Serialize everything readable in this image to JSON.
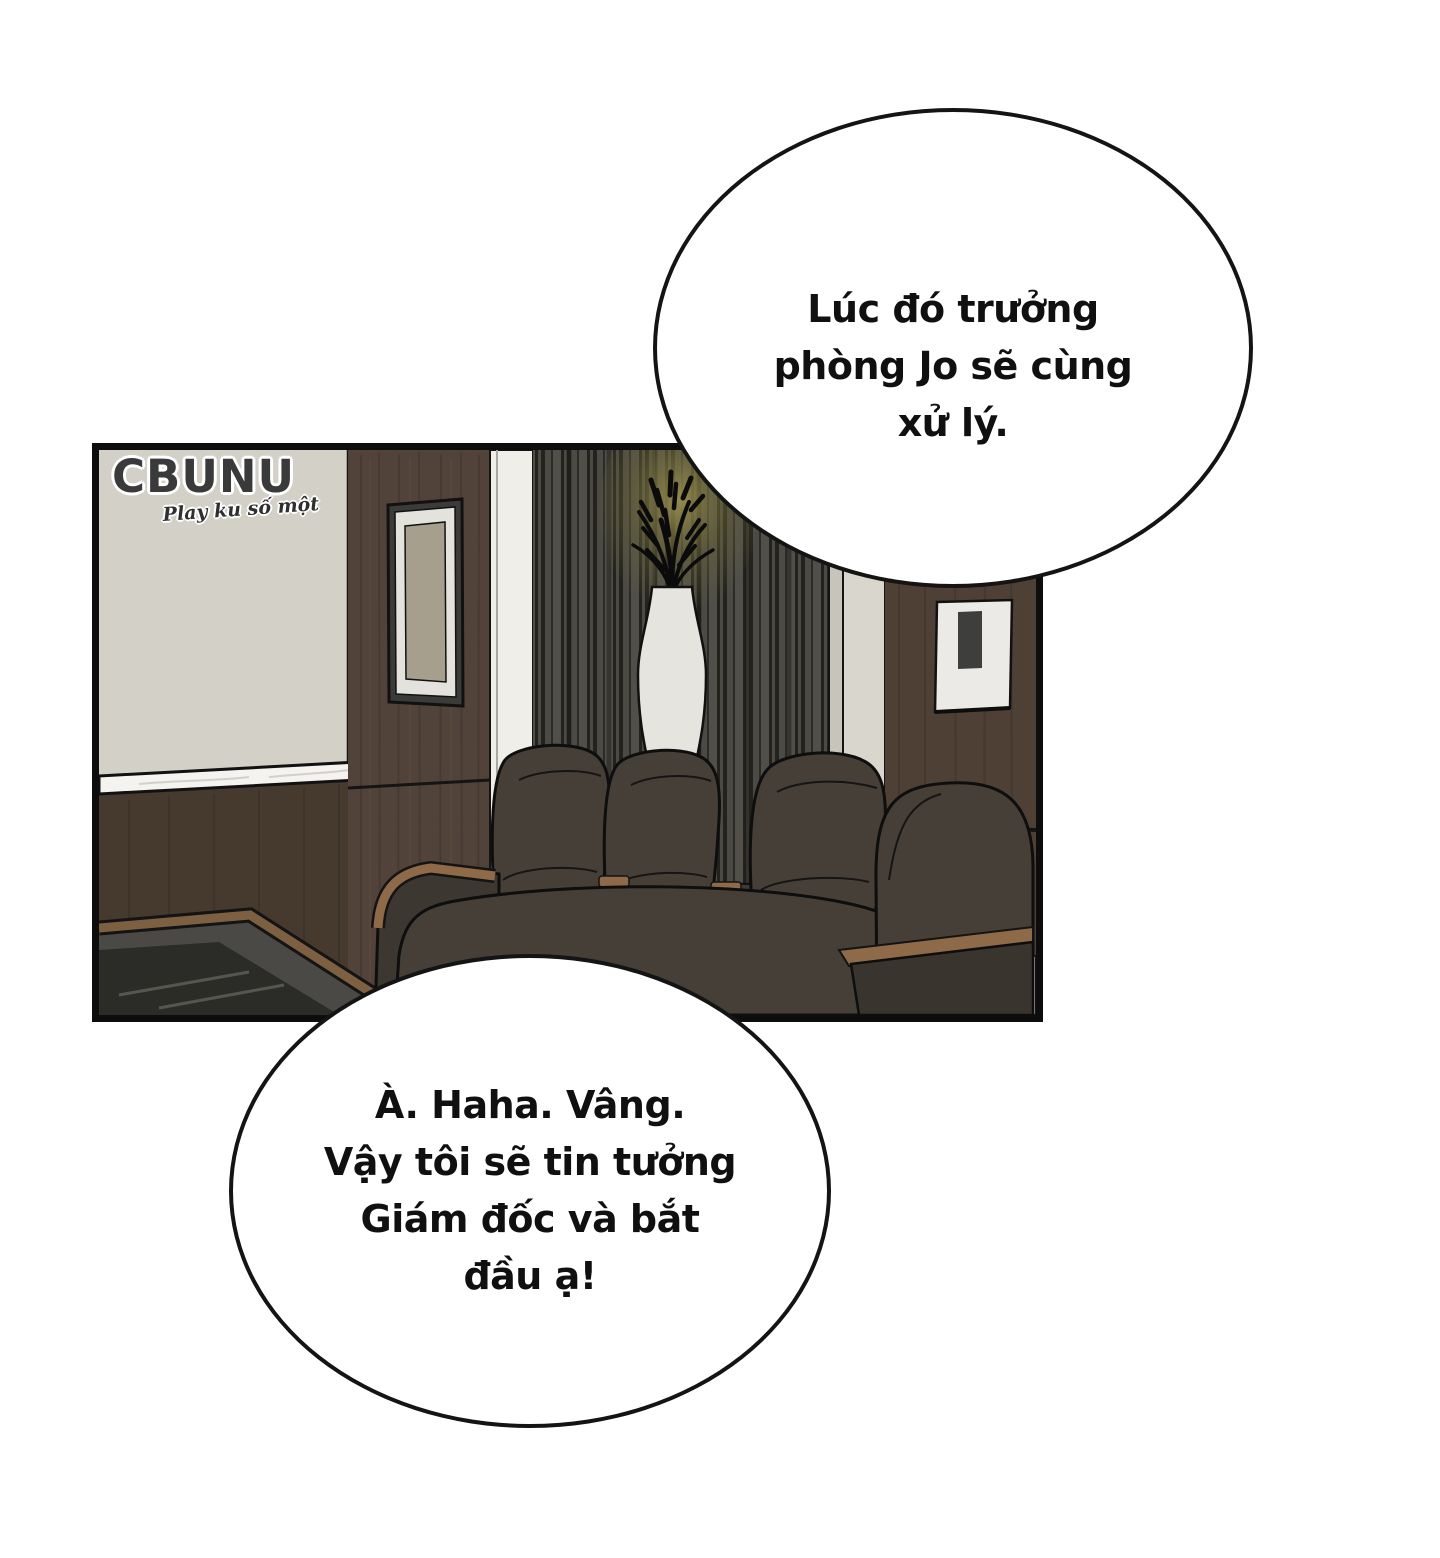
{
  "page": {
    "background": "#ffffff"
  },
  "watermark": {
    "brand": "CBUNU",
    "tagline": "Play ku số một"
  },
  "speech_bubbles": {
    "top": {
      "lines": {
        "0": "Lúc đó trưởng",
        "1": "phòng Jo sẽ cùng",
        "2": "xử lý."
      }
    },
    "bottom": {
      "lines": {
        "0": "À. Haha. Vâng.",
        "1": "Vậy tôi sẽ tin tưởng",
        "2": "Giám đốc và bắt",
        "3": "đầu ạ!"
      }
    }
  },
  "colors": {
    "panel_border": "#0d0d0d",
    "bubble_fill": "#ffffff",
    "bubble_stroke": "#141414",
    "text": "#101010",
    "wall_beige": "#d3d0c7",
    "wood_pillar": "#52433a",
    "wood_wainscot": "#463a2f",
    "wood_right_wall": "#4e4034",
    "slat_base": "#4b4a45",
    "slat_stripe": "#26251f",
    "column_white": "#f0eee9",
    "column_light": "#d9d6cd",
    "column_shadow": "#c7c4bb",
    "marble_ledge": "#f4f3ef",
    "floor_marble": "#dcdad4",
    "mirror_frame": "#3b3b39",
    "mirror_mat": "#e4e2dc",
    "mirror_glass": "#a69f8d",
    "picture_frame": "#eceae6",
    "picture_inner": "#3e3e3c",
    "vase": "#e6e4de",
    "plant": "#0b0b0b",
    "glow": "#9a8f4e",
    "chair_body": "#453f38",
    "chair_mid": "#403a34",
    "chair_dark": "#3d3731",
    "chair_darker": "#39342e",
    "wood_trim": "#8f6a49",
    "table_glass": "#4a4945",
    "table_glass_dark": "#262623",
    "table_wood": "#7d5f41"
  }
}
